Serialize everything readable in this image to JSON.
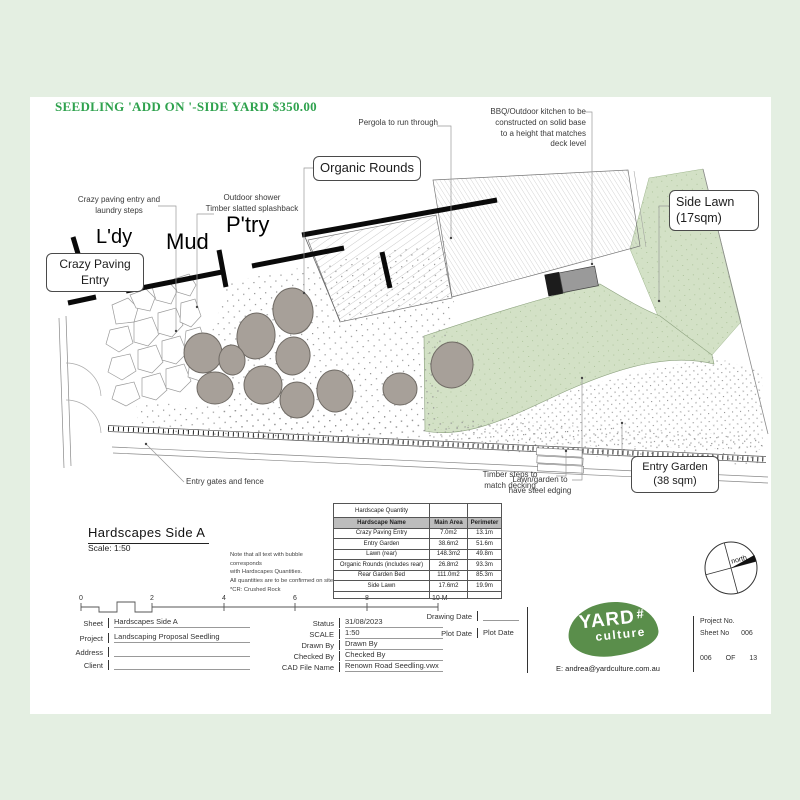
{
  "header": {
    "title": "SEEDLING 'ADD ON '-SIDE YARD $350.00"
  },
  "plan": {
    "rooms": {
      "laundry": "L'dy",
      "mud": "Mud",
      "pantry": "P'try"
    },
    "bubbles": {
      "crazy_paving": "Crazy Paving\nEntry",
      "organic_rounds": "Organic Rounds",
      "side_lawn": "Side Lawn\n(17sqm)",
      "entry_garden": "Entry Garden\n(38 sqm)"
    },
    "annotations": {
      "pergola": "Pergola to run through",
      "bbq": "BBQ/Outdoor kitchen to be\nconstructed on solid base\nto a height that matches\ndeck level",
      "crazy_paving": "Crazy paving entry and\nlaundry steps",
      "outdoor_shower": "Outdoor shower\nTimber slatted splashback",
      "entry_gates": "Entry gates and fence",
      "timber_steps": "Timber steps to\nmatch decking",
      "steel_edging": "Lawn/garden to\nhave steel edging"
    },
    "north_label": "north"
  },
  "sheet": {
    "title": "Hardscapes Side A",
    "scale": "Scale: 1:50",
    "notes": "Note that all text with bubble corresponds\nwith Hardscapes Quantities.\nAll quantities are to be confirmed on site\n*CR: Crushed Rock"
  },
  "table": {
    "title": "Hardscape Quantity",
    "columns": [
      "Hardscape Name",
      "Main Area",
      "Perimeter"
    ],
    "rows": [
      [
        "Crazy Paving Entry",
        "7.0m2",
        "13.1m"
      ],
      [
        "Entry Garden",
        "38.6m2",
        "51.6m"
      ],
      [
        "Lawn (rear)",
        "148.3m2",
        "49.8m"
      ],
      [
        "Organic Rounds (includes rear)",
        "26.8m2",
        "93.3m"
      ],
      [
        "Rear Garden Bed",
        "111.0m2",
        "85.3m"
      ],
      [
        "Side Lawn",
        "17.6m2",
        "19.9m"
      ]
    ]
  },
  "scale_bar": {
    "t0": "0",
    "t1": "2",
    "t2": "4",
    "t3": "6",
    "t4": "8",
    "t5": "10 M"
  },
  "title_block": {
    "sheet_label": "Sheet",
    "sheet_value": "Hardscapes Side A",
    "project_label": "Project",
    "project_value": "Landscaping Proposal Seedling",
    "address_label": "Address",
    "address_value": "",
    "client_label": "Client",
    "client_value": "",
    "status_label": "Status",
    "status_value": "31/08/2023",
    "scale_label": "SCALE",
    "scale_value": "1:50",
    "drawn_label": "Drawn By",
    "drawn_value": "Drawn By",
    "checked_label": "Checked By",
    "checked_value": "Checked By",
    "cad_label": "CAD File Name",
    "cad_value": "Renown Road Seedling.vwx",
    "drawing_date_label": "Drawing Date",
    "drawing_date_value": "",
    "plot_date_label": "Plot Date",
    "plot_date_value": "Plot Date",
    "project_no_label": "Project No.",
    "sheet_no_label": "Sheet No",
    "sheet_no_value": "006",
    "footer_left": "006",
    "footer_mid": "OF",
    "footer_right": "13"
  },
  "logo": {
    "word1": "YARD",
    "word2": "culture",
    "email": "E: andrea@yardculture.com.au"
  },
  "colors": {
    "background": "#e4efe2",
    "title_green": "#2fa24e",
    "logo_green": "#5a8e4b",
    "lawn_green": "#d3e1c6"
  }
}
